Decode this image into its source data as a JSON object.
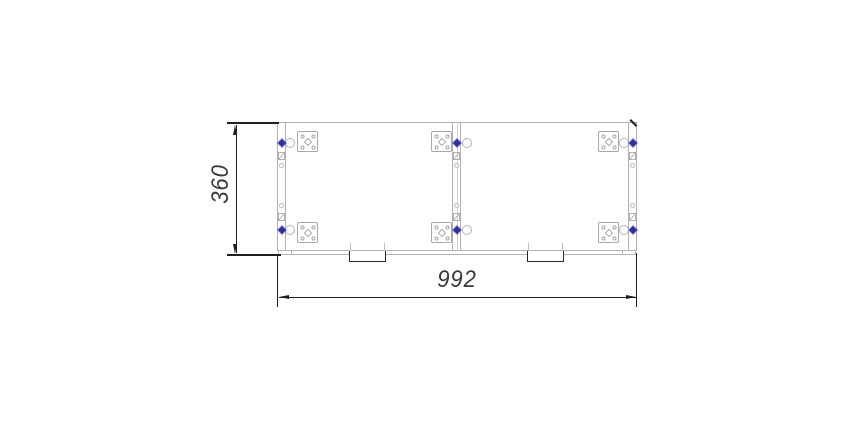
{
  "drawing": {
    "dimension_labels": {
      "height": "360",
      "width": "992"
    },
    "colors": {
      "geometry_line": "#b2b2b2",
      "plate_line": "#a8a8a8",
      "dimension_line": "#1f1f1f",
      "dimension_text": "#3a3a3a",
      "pin_accent": "#3030a0",
      "background": "#ffffff"
    },
    "components": {
      "modules": 2,
      "mounting_plates": 6,
      "locking_pins": 6,
      "latch_rings": 6,
      "hinge_blocks": 6,
      "strip_holes": 6,
      "bottom_tabs": 2,
      "corner_feet": 2
    }
  }
}
